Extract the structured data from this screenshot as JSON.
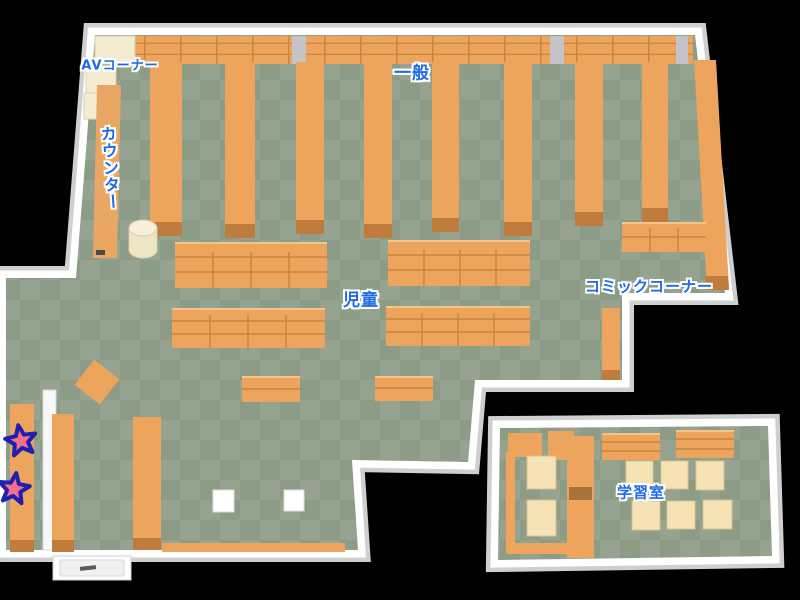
{
  "map": {
    "kind": "library-floor-map",
    "areas": [
      {
        "id": "av-corner",
        "label": "AVコーナー"
      },
      {
        "id": "general",
        "label": "一般"
      },
      {
        "id": "counter",
        "label": "カウンター"
      },
      {
        "id": "children",
        "label": "児童"
      },
      {
        "id": "comic-corner",
        "label": "コミックコーナー"
      },
      {
        "id": "study-room",
        "label": "学習室"
      }
    ],
    "markers": [
      {
        "id": "star-1",
        "shape": "star"
      },
      {
        "id": "star-2",
        "shape": "star"
      }
    ]
  },
  "colors": {
    "floor-dark": "#8d9c86",
    "floor-light": "#96a391",
    "shelf": "#eda45c",
    "shelf-dark": "#c9873f",
    "shelf-cap": "#c07c3c",
    "wall": "#ffffff",
    "wall-shadow": "#cfcfcf",
    "cream": "#f3ecd0",
    "counter": "#eaa763",
    "table": "#f5e3b5",
    "label-blue": "#1d6ae8",
    "star-pink": "#f4708c",
    "star-outline": "#2020b0",
    "bg": "#000000"
  }
}
